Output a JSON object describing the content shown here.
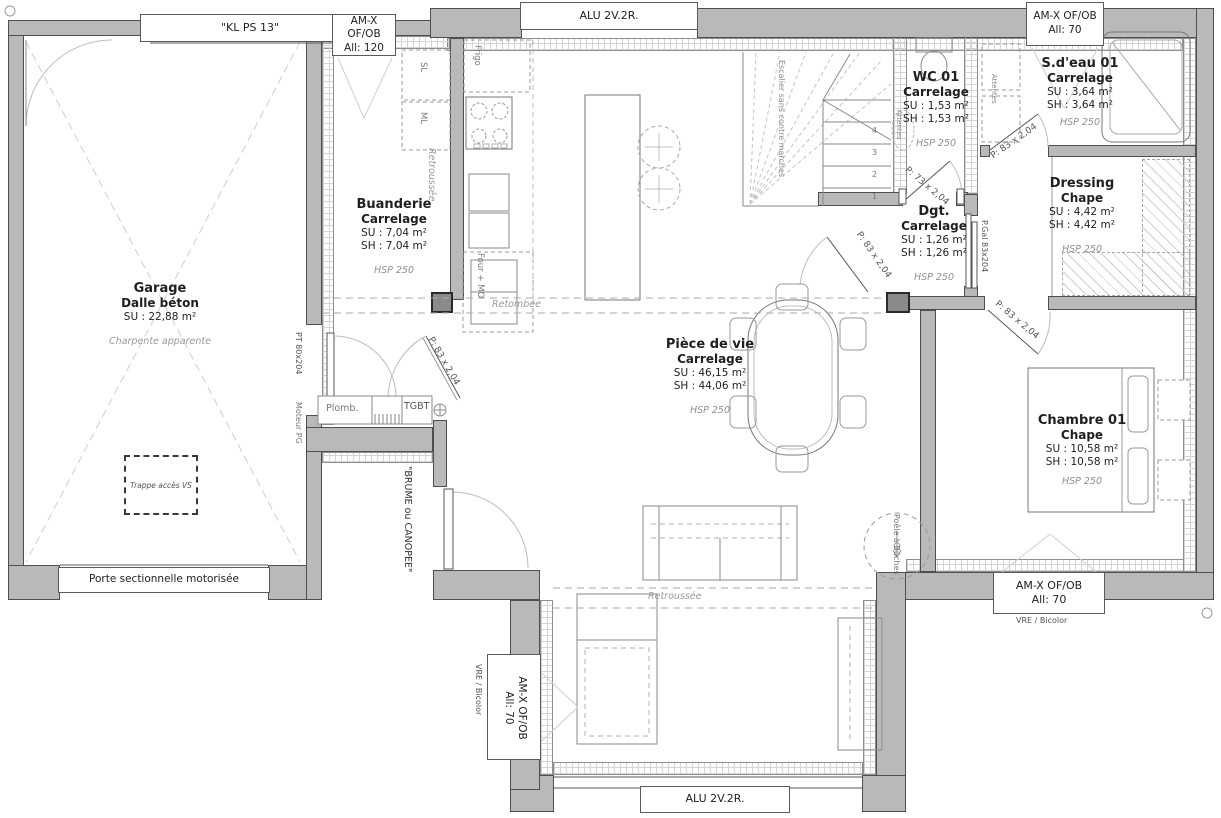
{
  "windows": {
    "kl_ps13": "\"KL PS 13\"",
    "amx_120": {
      "line1": "AM-X OF/OB",
      "line2": "All: 120"
    },
    "alu_top": "ALU 2V.2R.",
    "amx_70_top": {
      "line1": "AM-X OF/OB",
      "line2": "All: 70"
    },
    "amx_70_right": {
      "line1": "AM-X OF/OB",
      "line2": "All: 70",
      "note": "VRE / Bicolor"
    },
    "amx_70_left": {
      "line1": "AM-X OF/OB",
      "line2": "All: 70",
      "note": "VRE / Bicolor"
    },
    "alu_bottom": "ALU 2V.2R.",
    "garage_door": "Porte sectionnelle motorisée"
  },
  "rooms": {
    "garage": {
      "name": "Garage",
      "floor": "Dalle béton",
      "su": "SU : 22,88 m²",
      "note": "Charpente apparente"
    },
    "buanderie": {
      "name": "Buanderie",
      "floor": "Carrelage",
      "su": "SU : 7,04 m²",
      "sh": "SH : 7,04 m²",
      "hsp": "HSP 250"
    },
    "wc01": {
      "name": "WC 01",
      "floor": "Carrelage",
      "su": "SU : 1,53 m²",
      "sh": "SH : 1,53 m²",
      "hsp": "HSP 250"
    },
    "sdeau01": {
      "name": "S.d'eau 01",
      "floor": "Carrelage",
      "su": "SU : 3,64 m²",
      "sh": "SH : 3,64 m²",
      "hsp": "HSP 250"
    },
    "dressing": {
      "name": "Dressing",
      "floor": "Chape",
      "su": "SU : 4,42 m²",
      "sh": "SH : 4,42 m²",
      "hsp": "HSP 250"
    },
    "dgt": {
      "name": "Dgt.",
      "floor": "Carrelage",
      "su": "SU : 1,26 m²",
      "sh": "SH : 1,26 m²",
      "hsp": "HSP 250"
    },
    "piece_de_vie": {
      "name": "Pièce de vie",
      "floor": "Carrelage",
      "su": "SU : 46,15 m²",
      "sh": "SH : 44,06 m²",
      "hsp": "HSP 250"
    },
    "chambre01": {
      "name": "Chambre 01",
      "floor": "Chape",
      "su": "SU : 10,58 m²",
      "sh": "SH : 10,58 m²",
      "hsp": "HSP 250"
    }
  },
  "doors": {
    "pt_garage": "PT 80x204",
    "p83_kitchen": "P: 83 x 2,04",
    "p73_wc": "P: 73 x 2,04",
    "p83_sdeau": "P: 83 x 2,04",
    "p83_dgt": "P: 83 x 2,04",
    "p83_chambre": "P: 83 x 2,04",
    "pgal": "P.Gal 83x204"
  },
  "annotations": {
    "trappe": "Trappe accès VS",
    "brume": "\"BRUME ou CANOPEE\"",
    "escalier": "Escalier sans contre marches",
    "retroussee_kitchen": "Retroussée",
    "retombee": "Retombée",
    "retroussee_bottom": "Retroussée",
    "plomb": "Plomb.",
    "tgbt": "TGBT",
    "moteur": "Moteur PG",
    "poele": "Poêle à Bûches",
    "frigo": "Frigo",
    "sl": "SL",
    "ml": "ML",
    "four": "Four + MO",
    "attentes_wc": "Attentes",
    "attentes_sdeau": "Attentes"
  },
  "stairs": {
    "s1": "1",
    "s2": "2",
    "s3": "3",
    "s4": "4"
  }
}
